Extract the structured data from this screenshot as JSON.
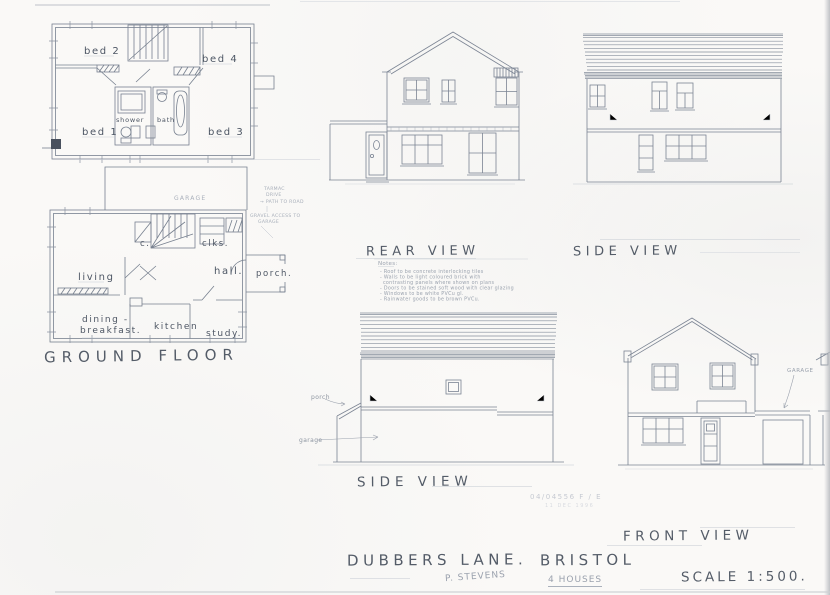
{
  "sheet": {
    "project_street": "DUBBERS LANE.",
    "project_city": "BRISTOL",
    "scale_note": "SCALE 1:500.",
    "pencil_name": "P. STEVENS",
    "pencil_houses": "4 HOUSES",
    "stamp_ref": "04/04556  F / E",
    "stamp_date": "11 DEC 1996"
  },
  "first_floor_plan": {
    "rooms": {
      "bed1": "bed 1",
      "bed2": "bed 2",
      "bed3": "bed 3",
      "bed4": "bed 4",
      "shower": "shower",
      "bath": "bath"
    }
  },
  "ground_floor_plan": {
    "label": "GROUND FLOOR",
    "rooms": {
      "living": "living",
      "dining_line1": "dining -",
      "dining_line2": "breakfast.",
      "kitchen": "kitchen",
      "study": "study.",
      "hall": "hall.",
      "cloaks": "clks.",
      "cupboard": "c.",
      "porch": "porch.",
      "garage": "GARAGE"
    },
    "annotations": {
      "drive_line1": "TARMAC",
      "drive_line2": "DRIVE",
      "drive_line3": "→ PATH TO ROAD",
      "access_line1": "GRAVEL ACCESS TO",
      "access_line2": "GARAGE"
    }
  },
  "elevations": {
    "rear_label": "REAR VIEW",
    "side_top_label": "SIDE VIEW",
    "side_bottom_label": "SIDE VIEW",
    "front_label": "FRONT VIEW",
    "side_bottom_porch_note": "porch",
    "side_bottom_garage_note": "garage",
    "front_garage_note": "GARAGE"
  },
  "notes": {
    "heading": "Notes:",
    "lines": [
      "- Roof to be concrete interlocking tiles",
      "- Walls to be light coloured brick with",
      "contrasting panels where shown on plans",
      "- Doors to be stained soft wood with clear glazing",
      "- Windows to be white PVCu gl.",
      "- Rainwater goods to be brown PVCu."
    ]
  }
}
